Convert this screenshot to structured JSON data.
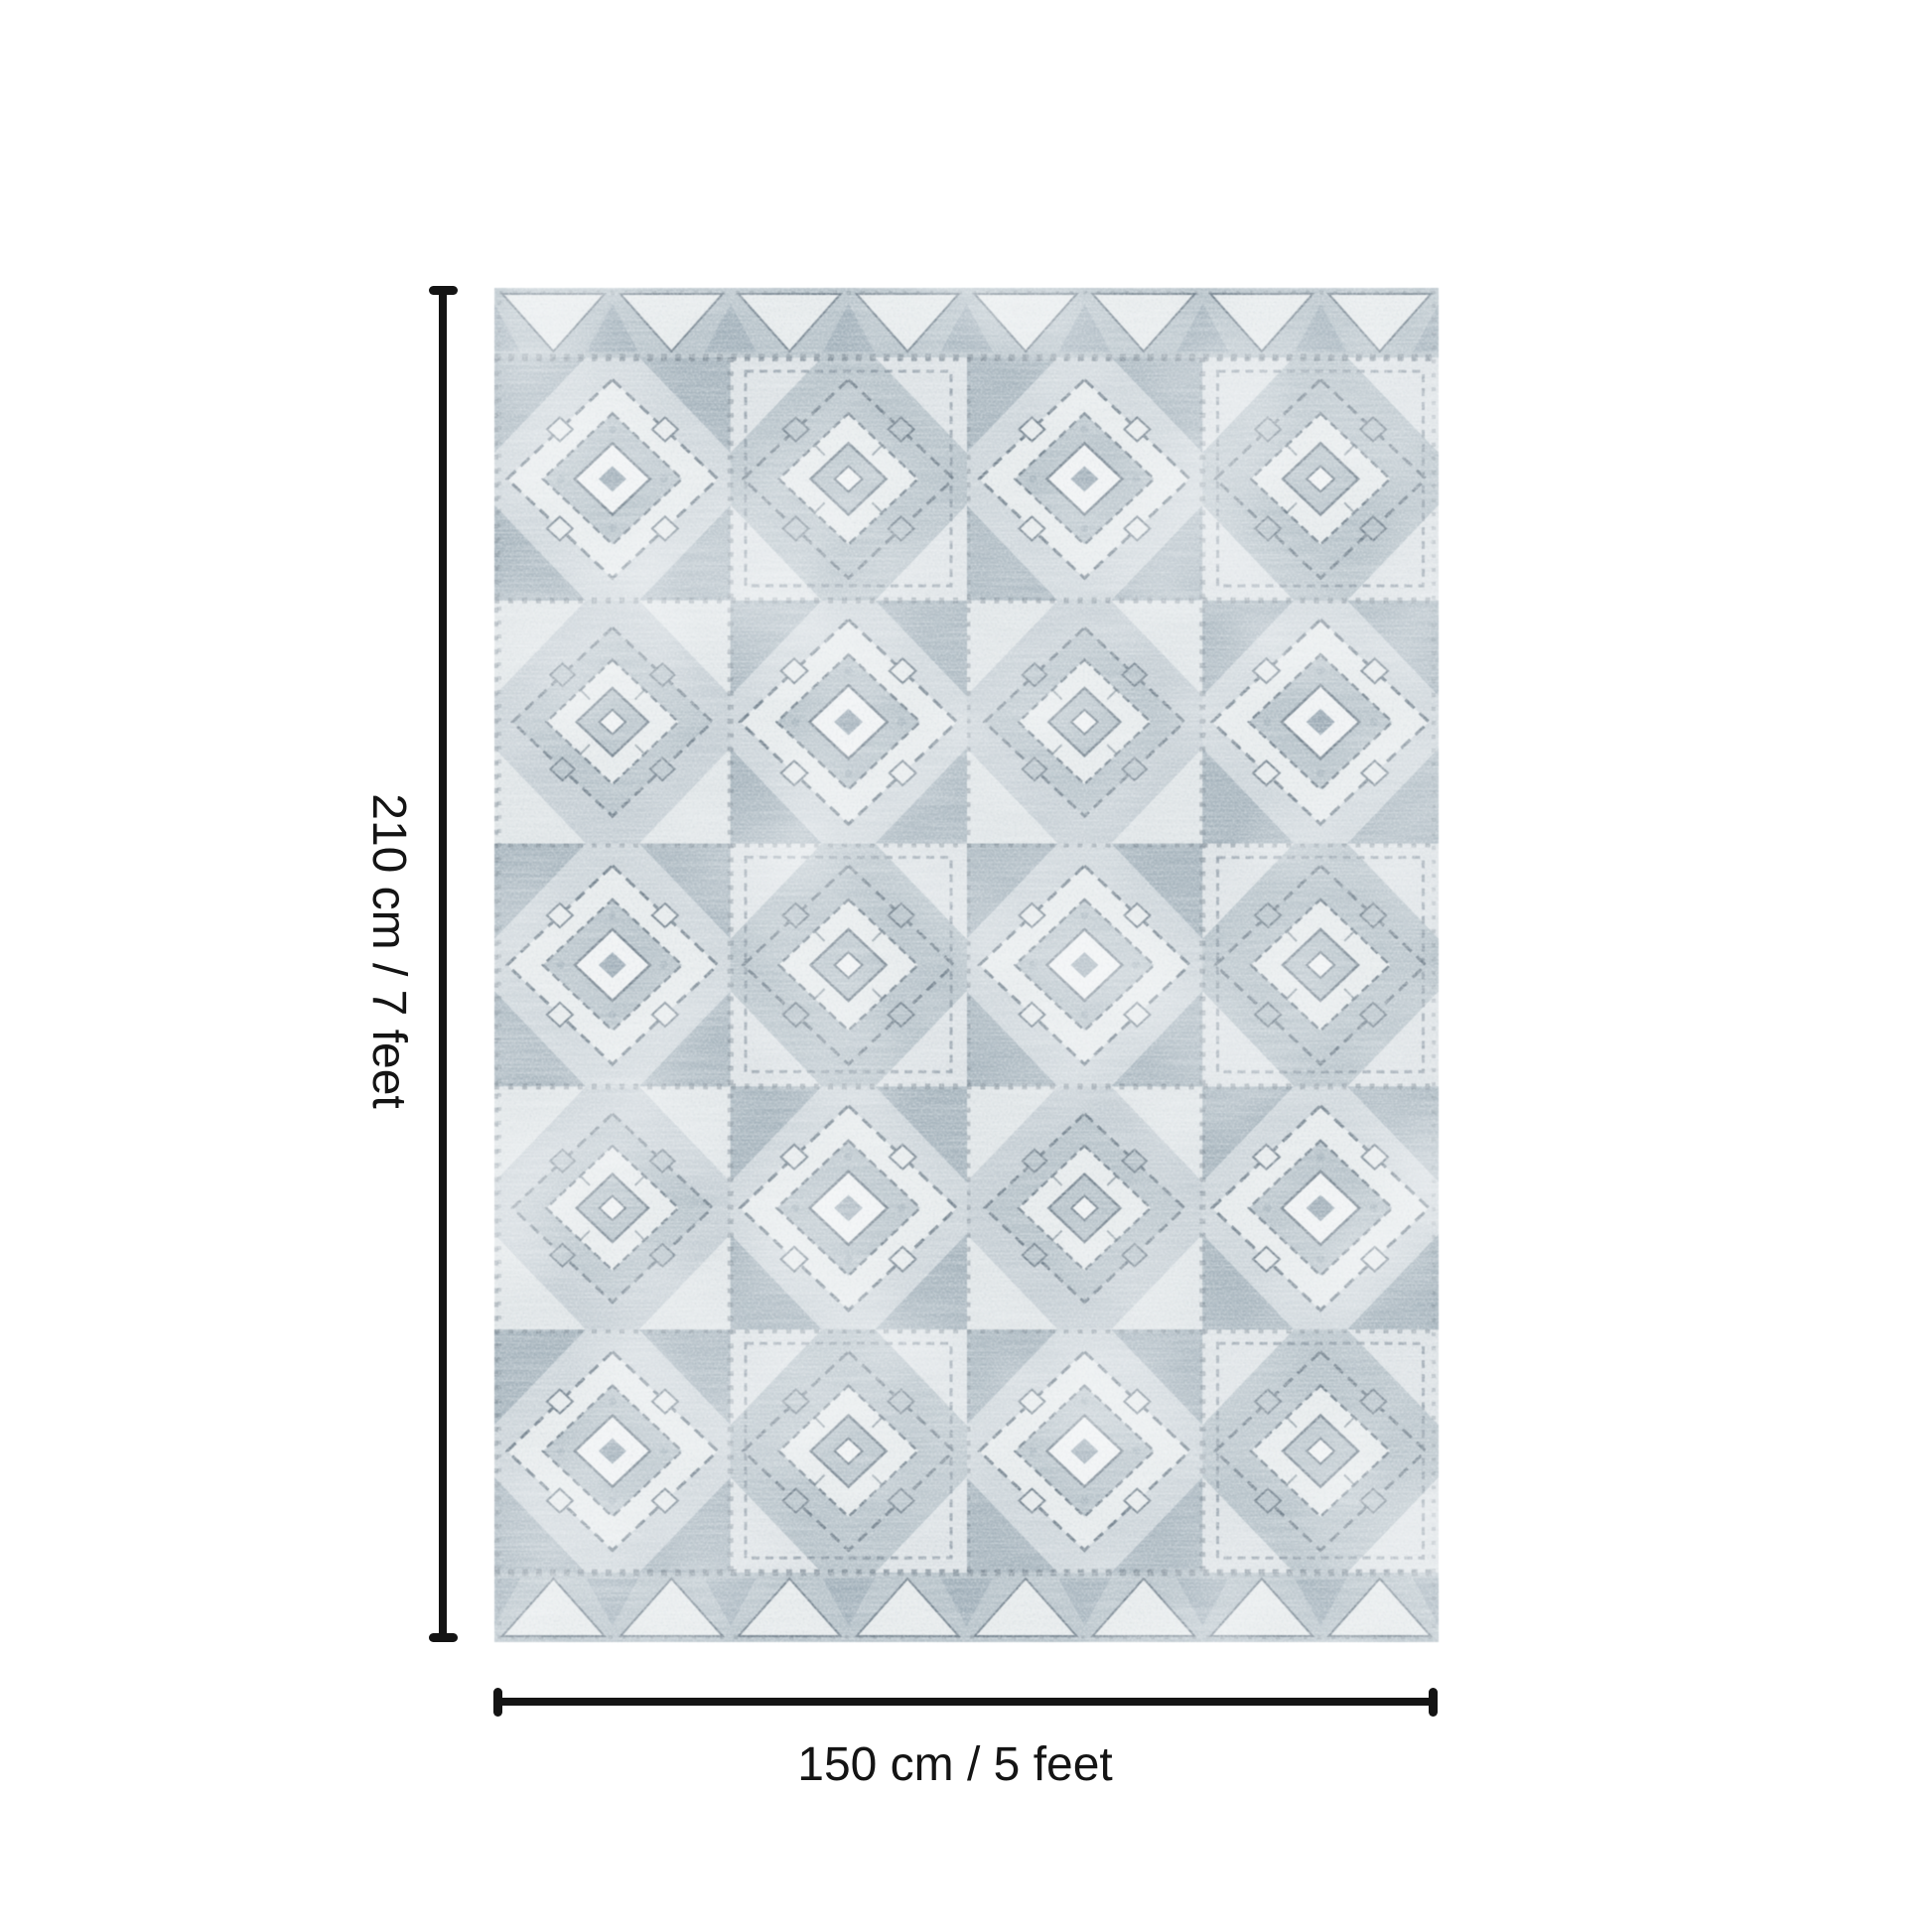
{
  "diagram": {
    "type": "rug-size-diagram",
    "height_dimension": {
      "label": "210 cm / 7 feet"
    },
    "width_dimension": {
      "label": "150 cm / 5 feet"
    }
  },
  "colors": {
    "page_background": "#ffffff",
    "ink": "#141414",
    "rug_base": "#ccd4d9",
    "rug_base2": "#c4cdd3",
    "rug_light": "#e7ebec",
    "rug_lighter": "#f1f3f4",
    "rug_mid": "#b4c0c7",
    "rug_dark": "#97a6b1",
    "rug_line": "#6d7c88"
  }
}
